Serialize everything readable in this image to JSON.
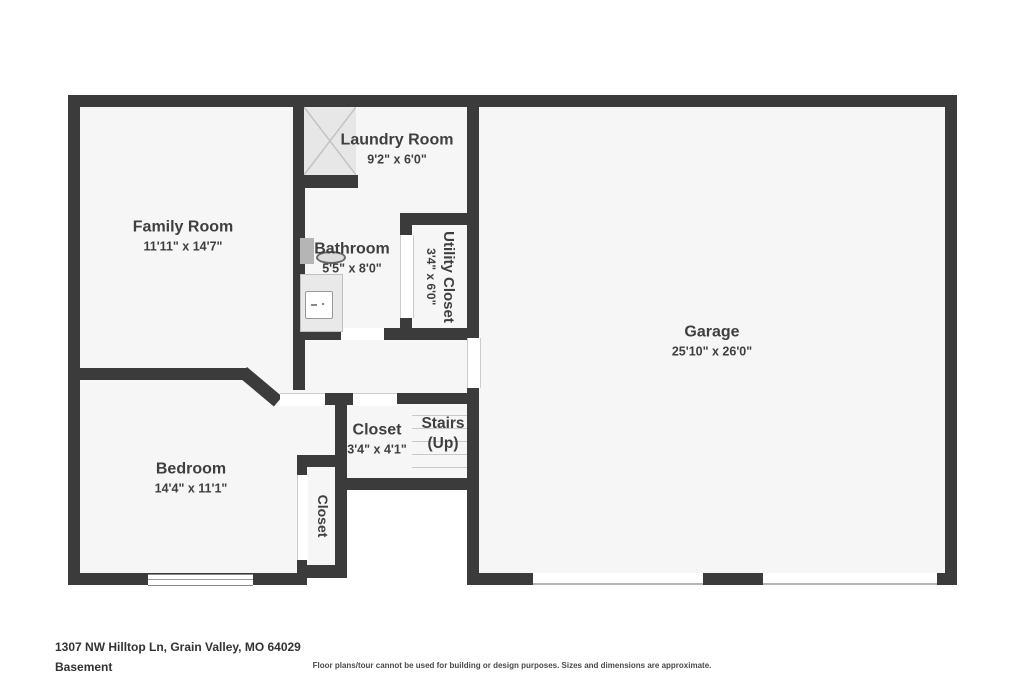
{
  "plan": {
    "title": "Basement floor plan",
    "rooms": {
      "family_room": {
        "name": "Family Room",
        "dims": "11'11\" x 14'7\""
      },
      "laundry": {
        "name": "Laundry Room",
        "dims": "9'2\" x 6'0\""
      },
      "bathroom": {
        "name": "Bathroom",
        "dims": "5'5\" x 8'0\""
      },
      "utility": {
        "name": "Utility Closet",
        "dims": "3'4\" x 6'0\""
      },
      "garage": {
        "name": "Garage",
        "dims": "25'10\" x 26'0\""
      },
      "closet_hall": {
        "name": "Closet",
        "dims": "3'4\" x 4'1\""
      },
      "stairs": {
        "name": "Stairs",
        "direction": "(Up)"
      },
      "bedroom": {
        "name": "Bedroom",
        "dims": "14'4\" x 11'1\""
      },
      "closet_bedroom": {
        "name": "Closet"
      }
    },
    "fixtures": [
      "hatched-area-icon",
      "toilet-icon",
      "sink-icon",
      "vanity-counter",
      "window",
      "garage-door-opening"
    ],
    "colors": {
      "wall": "#3b3b3b",
      "floor": "#f6f6f6",
      "text": "#3f3f3f",
      "hatch_fill": "#e7e7e7"
    }
  },
  "footer": {
    "address": "1307 NW Hilltop Ln, Grain Valley, MO 64029",
    "level": "Basement",
    "disclaimer": "Floor plans/tour cannot be used for building or design purposes. Sizes and dimensions are approximate."
  }
}
